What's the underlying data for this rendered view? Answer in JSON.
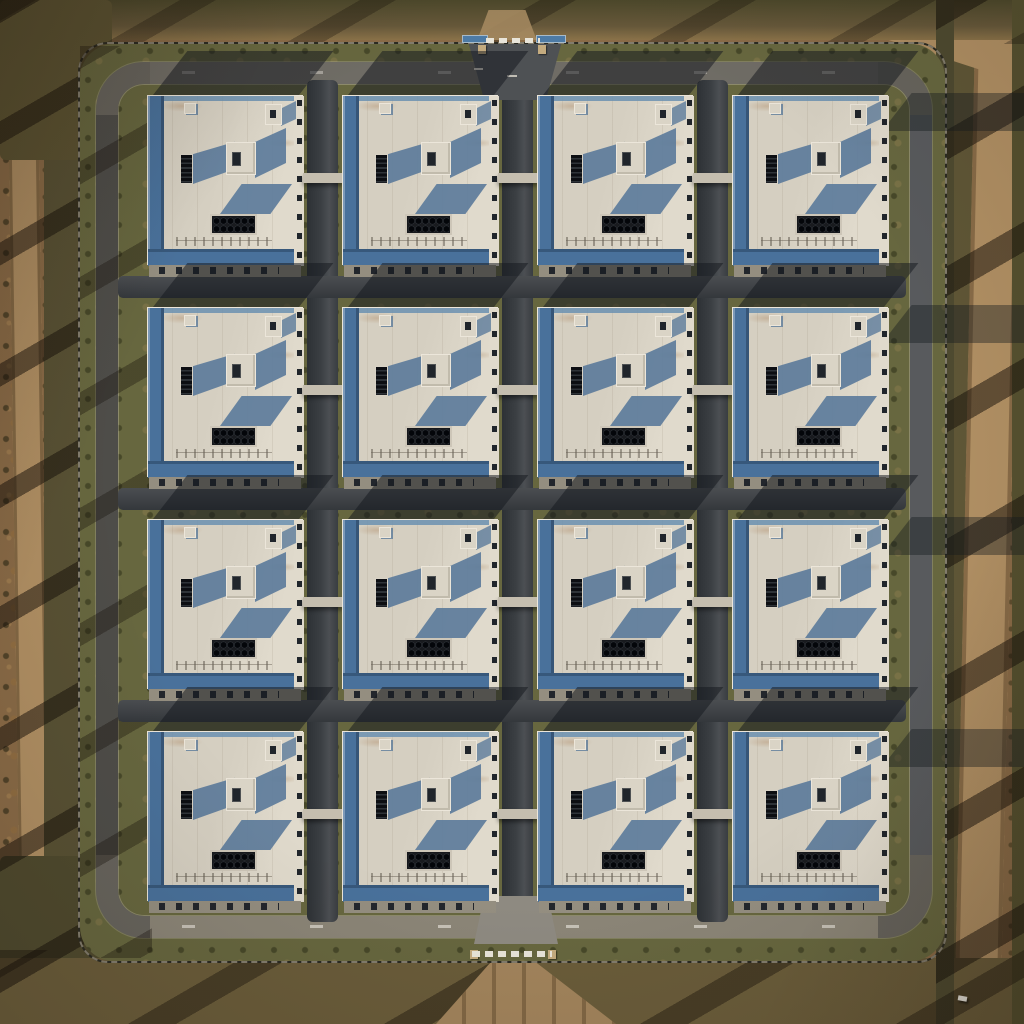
{
  "scene": {
    "kind": "aerial-drone-photograph",
    "subject": "fenced industrial campus with a 4x4 grid of identical white flat-roof warehouse buildings",
    "lighting": "low sun, long shadows cast toward upper-right",
    "grid": {
      "rows": 4,
      "cols": 4,
      "origin_x": 147,
      "origin_y": 95,
      "step_x": 195,
      "step_y": 212,
      "building_width": 156,
      "building_height": 170
    },
    "counts": {
      "buildings": 16,
      "hvac_fans_per_unit": 12,
      "perimeter_gates": 2
    },
    "features": [
      "perimeter-fence",
      "perimeter-ring-road",
      "internal-road-grid",
      "rooftop-hvac-unit",
      "rooftop-penthouse",
      "rooftop-vent-unit",
      "loading-dock-apron",
      "inter-building-link",
      "north-gate",
      "south-gate",
      "dirt-road-west",
      "dirt-road-east",
      "scrub-vegetation",
      "tree-shadow-stripes"
    ]
  },
  "colors": {
    "terrain": "#8a6b47",
    "dirt_road": "#b08f63",
    "veg_dark": "#4e4a2e",
    "veg_mid": "#5f5636",
    "shadow_stripe": "rgba(20,14,8,0.5)",
    "fence": "#2b2a22",
    "fence_post": "#c9c0ab",
    "ring_base": "#67645d",
    "ring_top": "#6f6c65",
    "ring_bottom": "#8b8577",
    "ring_left": "#4e4d49",
    "ring_right": "#585a5d",
    "verge": "#67673f",
    "road": "#3c4044",
    "roof": "#d5cfc1",
    "roof_bright": "#e0dacc",
    "roof_edge": "#ece6da",
    "blue_wall": "#49719b",
    "blue_light": "#6b90b0",
    "roof_shadow": "#5d7c9b",
    "ground_shadow": "rgba(21,25,31,0.52)",
    "vent": "#14161a",
    "penthouse": "#dad4c6",
    "window_dark": "#20252b",
    "hvac_frame": "#cdc6b8",
    "hvac_dark": "#16181c",
    "apron": "#948e80",
    "apron_dash": "#22262c",
    "gate_road": "#a2845c",
    "gate_bar": "#e9e5da",
    "bridge": "#c5beaf",
    "sign_blue": "#4d7ba6",
    "car": "#e6e3db"
  }
}
